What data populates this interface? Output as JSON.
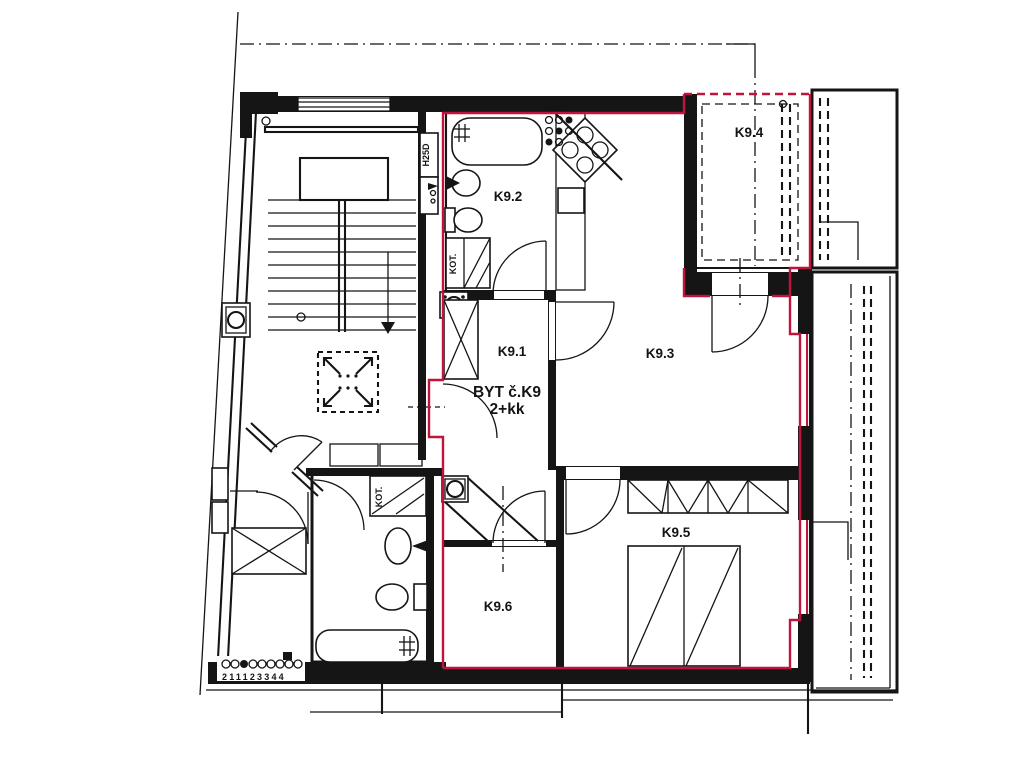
{
  "plan": {
    "type": "architectural-floor-plan",
    "apartment": {
      "line1": "BYT č.K9",
      "line2": "2+kk"
    },
    "rooms": [
      {
        "id": "K9.1",
        "label": "K9.1",
        "kind": "hall"
      },
      {
        "id": "K9.2",
        "label": "K9.2",
        "kind": "bathroom"
      },
      {
        "id": "K9.3",
        "label": "K9.3",
        "kind": "living-room-with-kitchen"
      },
      {
        "id": "K9.4",
        "label": "K9.4",
        "kind": "terrace"
      },
      {
        "id": "K9.5",
        "label": "K9.5",
        "kind": "bedroom"
      },
      {
        "id": "K9.6",
        "label": "K9.6",
        "kind": "room"
      }
    ],
    "annotations": {
      "h25d": "H25D",
      "kot_a": "KOT.",
      "kot_b": "KOT.",
      "risers_top": "2111",
      "risers_bottom": "211123344"
    },
    "colors": {
      "boundary_red": "#c0143c",
      "line_black": "#151515",
      "background": "#ffffff"
    },
    "icons": [
      "staircase",
      "elevator-skylight",
      "bathtub-icon",
      "sink-icon",
      "toilet-icon",
      "stove-icon",
      "boiler-icon",
      "bed-icon",
      "wardrobe-icon",
      "fan-shaft-icon",
      "door-arc",
      "riser-circles"
    ]
  }
}
